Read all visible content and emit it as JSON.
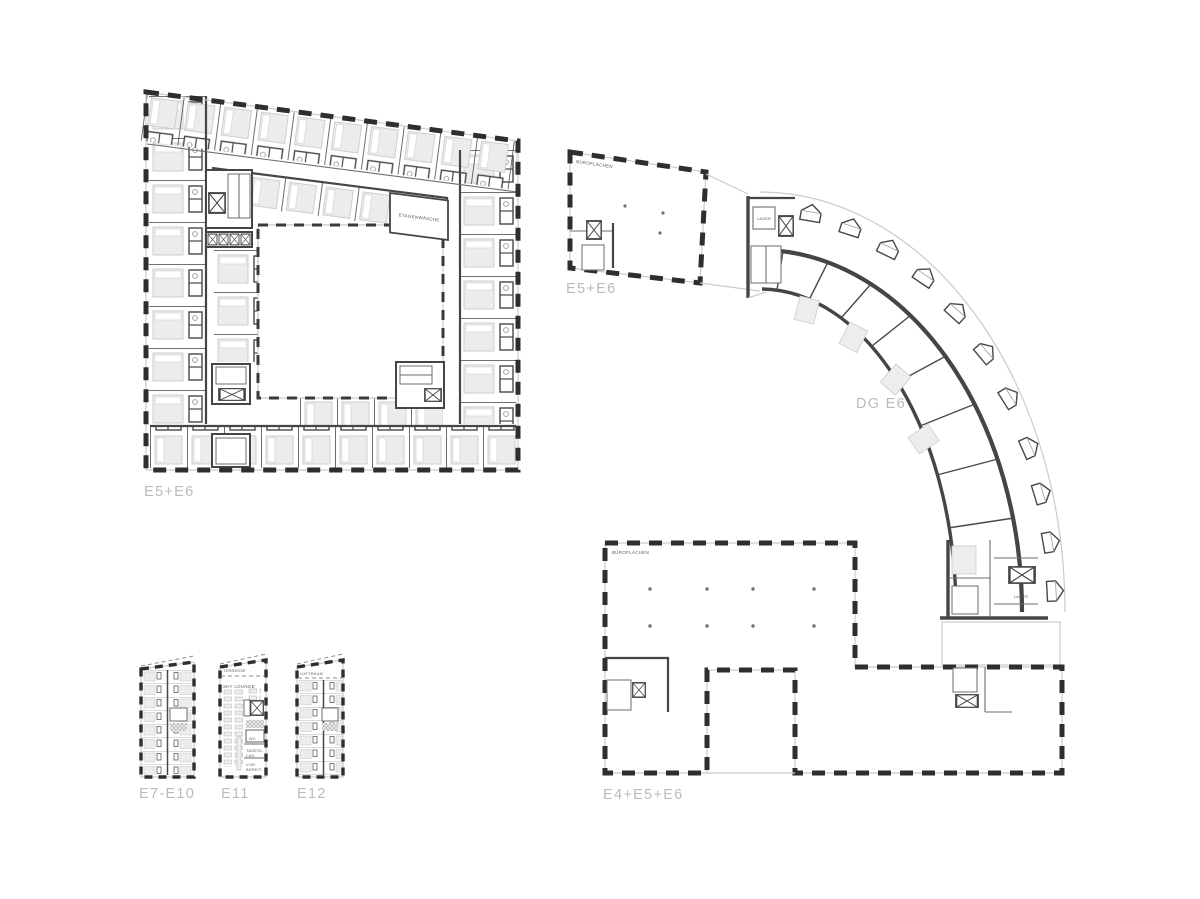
{
  "sheet": {
    "background": "#ffffff"
  },
  "colors": {
    "label_gray": "#b9bbbd",
    "wall_dark": "#454547",
    "facade_black": "#2e2e30",
    "line_light": "#c9cbcd",
    "room_text": "#55575a",
    "bed_fill": "#ededee"
  },
  "plans": {
    "hotel_ring": {
      "label": "E5+E6",
      "laundry_room": "ETAGENWÄSCHE"
    },
    "attic_wing": {
      "label": "DG E6",
      "office_area": "BÜROFLÄCHEN",
      "office_area_floor": "E5+E6",
      "storage_top": "LAGER",
      "storage_bottom": "LAGER"
    },
    "office_block": {
      "label": "E4+E5+E6",
      "office_area": "BÜROFLÄCHEN"
    },
    "tower_typical": {
      "label": "E7-E10"
    },
    "tower_sky": {
      "label": "E11",
      "terrace": "TERRASSE",
      "lounge": "SKY LOUNGE",
      "wc": "WC",
      "daylight_storage_1": "TAGESL.",
      "daylight_storage_2": "LAG.",
      "prep_1": "VOR-",
      "prep_2": "BEREIT."
    },
    "tower_roof": {
      "label": "E12",
      "void": "LUFTRAUM"
    }
  }
}
